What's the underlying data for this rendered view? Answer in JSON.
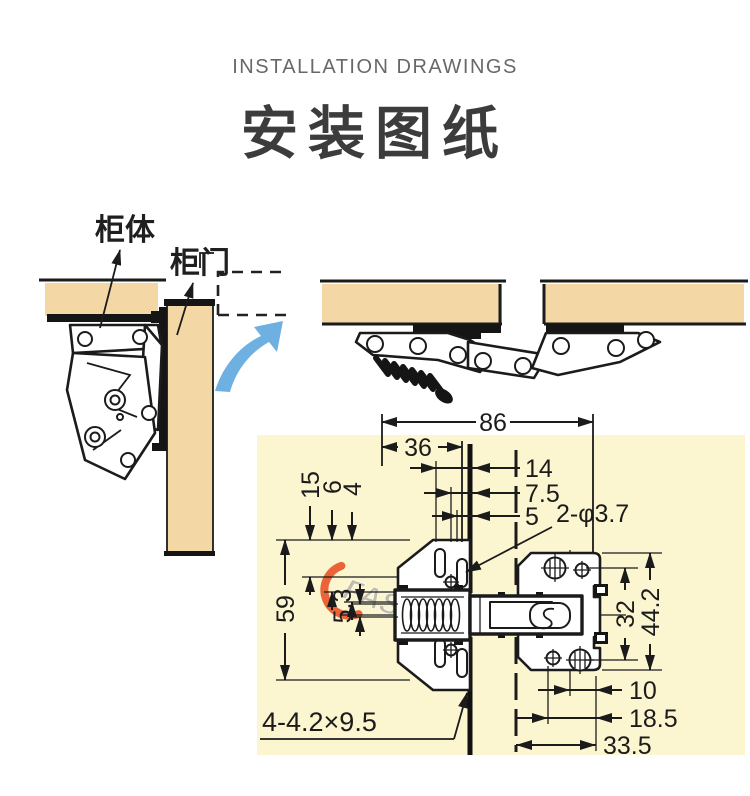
{
  "header": {
    "subtitle": "INSTALLATION DRAWINGS",
    "title": "安装图纸"
  },
  "closed_view": {
    "label_cabinet": "柜体",
    "label_door": "柜门"
  },
  "watermark": {
    "text": "FASTINY"
  },
  "dims": {
    "d86": "86",
    "d36": "36",
    "d14": "14",
    "d75": "7.5",
    "d5": "5",
    "holes": "2-φ3.7",
    "d15": "15",
    "d6": "6",
    "d4": "4",
    "d59": "59",
    "d53": "5.3",
    "d32": "32",
    "d442": "44.2",
    "d10": "10",
    "d185": "18.5",
    "d335": "33.5",
    "slots": "4-4.2×9.5"
  },
  "colors": {
    "wood": "#f3d8a6",
    "drawing_background": "#fbf5d0",
    "line": "#1b1b1b",
    "arrow_blue": "#6fb0e2",
    "watermark_red": "#e84b1e",
    "subtitle_gray": "#686868",
    "title_gray": "#3c3c3c"
  }
}
